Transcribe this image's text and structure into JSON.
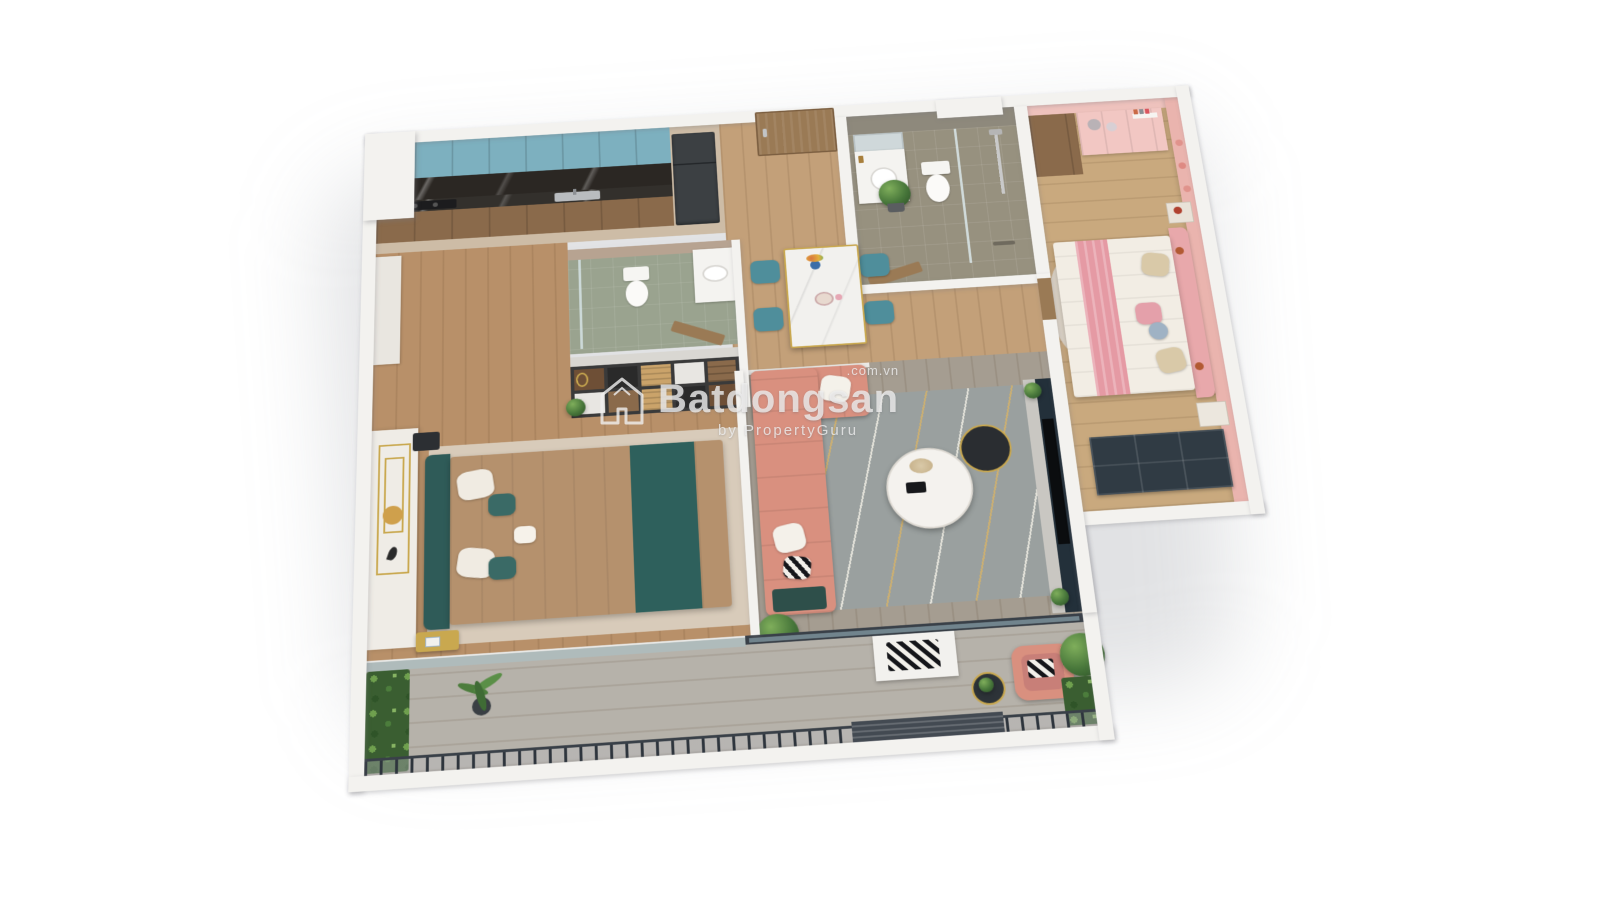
{
  "watermark": {
    "brand": "Batdongsan",
    "domain_suffix": ".com.vn",
    "byline": "by PropertyGuru",
    "logo": "batdongsan-house-logo"
  },
  "scene": {
    "type": "3d-isometric-apartment-floorplan-render",
    "background": "#ffffff",
    "palette": {
      "wall": "#f3f2ef",
      "wood_floor": "#c3a079",
      "kitchen_floor": "#cdbca6",
      "dressing_floor": "#b89069",
      "living_floor": "#a59d91",
      "kids_floor": "#c9a97e",
      "balcony_floor": "#b6b2aa",
      "stone_tile": "#97917f",
      "stone_wall": "#8e897c",
      "wc_tile": "#9aa38f",
      "teal_cabinet": "#7db0bf",
      "backsplash_dark": "#2b2723",
      "counter_dark": "#33302c",
      "base_cabinet_wood": "#8a6a4b",
      "fridge_dark": "#3c4043",
      "door_wood": "#9a7a55",
      "marble_half_wall": "#b7a391",
      "pink_wall": "#eab4ae",
      "pink_vanity": "#f2c7c3",
      "kids_headboard": "#e8a8ab",
      "kids_throw": "#e59aa4",
      "duvet_white": "#f2ede4",
      "kids_rug": "#ded5c8",
      "master_rug": "#d8cbba",
      "master_duvet": "#b5916d",
      "master_teal": "#2e605c",
      "master_headboard": "#2f5b58",
      "art_wall": "#efece6",
      "gold_accent": "#c9a84f",
      "sofa_coral": "#d9907f",
      "living_rug": "#9aa09f",
      "chair_teal": "#4f8e9b",
      "table_marble": "#f2f1ee",
      "tv_console": "#23303a",
      "tv_screen": "#0b0d0f",
      "drawers_dark": "#303b44",
      "railing_dark": "#394048",
      "louver": "#434a52",
      "glass": "#aebfc4",
      "plant_green": "#47763a",
      "watermark_text": "rgba(240,240,240,0.78)"
    },
    "rooms": [
      {
        "name": "kitchen",
        "furniture": [
          "teal upper cabinets",
          "black marble backsplash",
          "dark countertop",
          "wooden base cabinets",
          "induction cooktop",
          "kitchen sink",
          "refrigerator"
        ]
      },
      {
        "name": "entry",
        "furniture": [
          "wooden entry door",
          "potted plant"
        ]
      },
      {
        "name": "guest-wc",
        "furniture": [
          "toilet",
          "white vanity with oval basin",
          "glass shower screen",
          "wooden door",
          "marble half wall"
        ]
      },
      {
        "name": "dressing-area",
        "furniture": [
          "open wardrobe shelving",
          "folded clothes",
          "gold clothes ring",
          "plant"
        ]
      },
      {
        "name": "master-bedroom",
        "furniture": [
          "double bed with tan duvet",
          "dark teal runner",
          "dark teal headboard",
          "white and teal pillows",
          "gold nightstand",
          "black side table",
          "panelled art wall with gold trim",
          "beige rug"
        ]
      },
      {
        "name": "dining-area",
        "furniture": [
          "white marble dining table with gold legs",
          "four teal chairs",
          "flower vase",
          "serving plate"
        ]
      },
      {
        "name": "living-room",
        "furniture": [
          "coral l-shaped sofa",
          "white cushions",
          "chevron cushion",
          "two-tier round coffee table",
          "gray rug with gold wavy pattern",
          "tv console",
          "television",
          "potted plants"
        ]
      },
      {
        "name": "master-bathroom",
        "furniture": [
          "stone tiled walls",
          "mirror",
          "white vanity with round basin",
          "toilet",
          "walk-in rain shower",
          "glass partition",
          "wooden door"
        ]
      },
      {
        "name": "kids-bedroom",
        "furniture": [
          "bed with white duvet and pink throw",
          "pink tufted headboard",
          "plush toys",
          "pink vanity desk",
          "wooden wardrobe",
          "dark drawer unit",
          "floating bookshelf",
          "heart wall decor",
          "pink mural wall",
          "shaggy rug",
          "nightstand with lamp"
        ]
      },
      {
        "name": "balcony",
        "furniture": [
          "dark metal railing",
          "louver panel",
          "vertical garden walls",
          "palm plant",
          "large potted plant",
          "pink armchair",
          "bench with chevron cushion",
          "round side table",
          "glass sliding doors"
        ]
      }
    ]
  }
}
